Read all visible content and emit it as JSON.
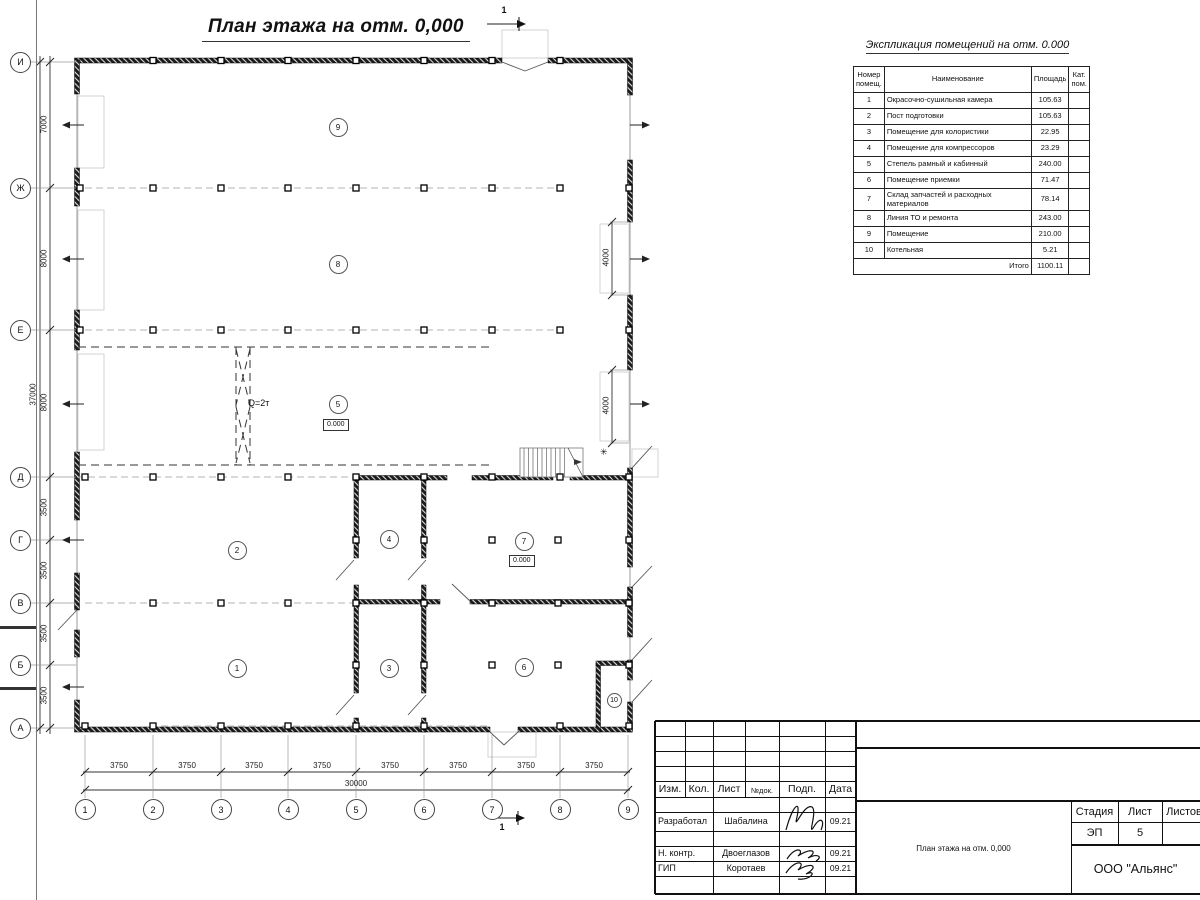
{
  "drawing_title": "План этажа на отм. 0,000",
  "plan": {
    "axes_vertical": [
      "И",
      "Ж",
      "Е",
      "Д",
      "Г",
      "В",
      "Б",
      "А"
    ],
    "axes_horizontal": [
      "1",
      "2",
      "3",
      "4",
      "5",
      "6",
      "7",
      "8",
      "9"
    ],
    "dims_left": [
      "7000",
      "8000",
      "8000",
      "3500",
      "3500",
      "3500",
      "3500"
    ],
    "dim_left_total": "37000",
    "dims_bottom": [
      "3750",
      "3750",
      "3750",
      "3750",
      "3750",
      "3750",
      "3750",
      "3750"
    ],
    "dim_bottom_total": "30000",
    "dims_right_gates": [
      "4000",
      "4000"
    ],
    "crane_label": "Q=2т",
    "elevation_marks": [
      "0.000",
      "0.000"
    ],
    "room_numbers": [
      "1",
      "2",
      "3",
      "4",
      "5",
      "6",
      "7",
      "8",
      "9",
      "10"
    ],
    "section_marks": [
      "1",
      "1"
    ],
    "asterisk": "✳"
  },
  "schedule": {
    "title": "Экспликация помещений на отм. 0.000",
    "headers": [
      "Номер помещ.",
      "Наименование",
      "Площадь",
      "Кат. пом."
    ],
    "rows": [
      [
        "1",
        "Окрасочно-сушильная камера",
        "105.63"
      ],
      [
        "2",
        "Пост подготовки",
        "105.63"
      ],
      [
        "3",
        "Помещение для колористики",
        "22.95"
      ],
      [
        "4",
        "Помещение для компрессоров",
        "23.29"
      ],
      [
        "5",
        "Степель рамный и кабинный",
        "240.00"
      ],
      [
        "6",
        "Помещение приемки",
        "71.47"
      ],
      [
        "7",
        "Склад запчастей и расходных материалов",
        "78.14"
      ],
      [
        "8",
        "Линия ТО и ремонта",
        "243.00"
      ],
      [
        "9",
        "Помещение",
        "210.00"
      ],
      [
        "10",
        "Котельная",
        "5.21"
      ]
    ],
    "total_label": "Итого",
    "total_value": "1100.11"
  },
  "titleblock": {
    "columns": [
      "Изм.",
      "Кол.",
      "Лист",
      "№док.",
      "Подп.",
      "Дата"
    ],
    "signers": [
      {
        "role": "Разработал",
        "name": "Шабалина",
        "date": "09.21"
      },
      {
        "role": "Н. контр.",
        "name": "Двоеглазов",
        "date": "09.21"
      },
      {
        "role": "ГИП",
        "name": "Коротаев",
        "date": "09.21"
      }
    ],
    "stage_headers": [
      "Стадия",
      "Лист",
      "Листов"
    ],
    "stage": "ЭП",
    "sheet": "5",
    "doc_title": "План этажа на отм. 0,000",
    "company": "ООО \"Альянс\""
  }
}
